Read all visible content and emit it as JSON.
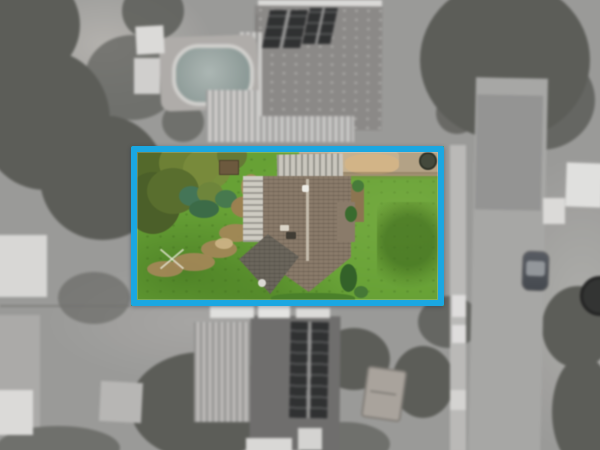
{
  "colors": {
    "boundary": "#1aa7e2",
    "lawn": "#6aa03c",
    "roof": "#897b6b",
    "roof-front": "#6b665d",
    "metal": "#cecbc3",
    "garage": "#c9c6be",
    "path": "#a2875c",
    "gravel": "#b2a288",
    "sand": "#d0b48b",
    "tree": "#575c4a",
    "ground": "#97968d",
    "road": "#a3a29b",
    "footpath": "#b7b4ab",
    "white-roof": "#d6d3cb",
    "dark-roof": "#6f6b64",
    "solar": "#2b3036",
    "pool": "#69a093",
    "pool-deck": "#b2a698",
    "car-glass": "#8494a4",
    "trailer": "#b49c80"
  }
}
